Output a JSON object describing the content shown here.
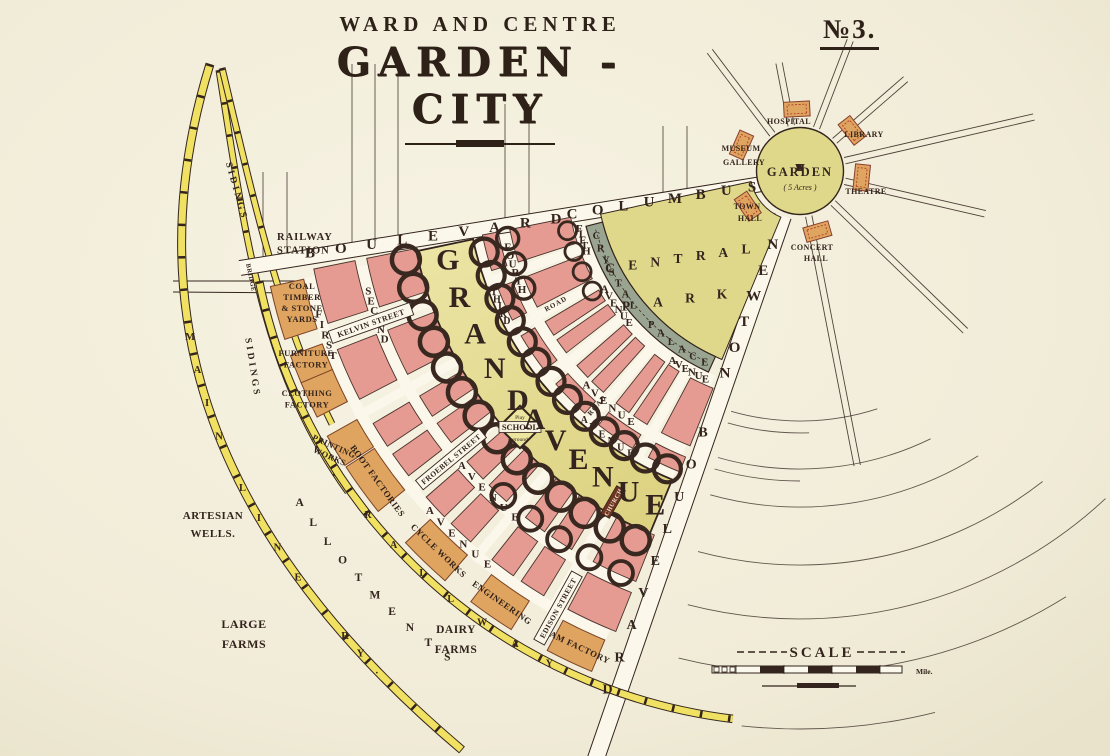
{
  "page": {
    "plate_number": "№3.",
    "title_line1": "WARD AND CENTRE",
    "title_line2": "GARDEN - CITY"
  },
  "colors": {
    "paper": "#f3efdd",
    "housing_pink": "#e59b92",
    "park_green": "#dfd88b",
    "grand_yellow": "#e6df95",
    "crystal_grey": "#9aa591",
    "factory_orange": "#dfa45f",
    "railway_yellow": "#f0e163",
    "ink": "#33241d"
  },
  "centre": {
    "garden_label": "GARDEN",
    "garden_acreage": "( 5 Acres )",
    "buildings": [
      {
        "label": "HOSPITAL",
        "lines": [
          "HOSPITAL"
        ]
      },
      {
        "label": "LIBRARY",
        "lines": [
          "LIBRARY"
        ]
      },
      {
        "label": "MUSEUM GALLERY",
        "lines": [
          "MUSEUM",
          "GALLERY"
        ]
      },
      {
        "label": "THEATRE",
        "lines": [
          "THEATRE"
        ]
      },
      {
        "label": "TOWN HALL",
        "lines": [
          "TOWN",
          "HALL"
        ]
      },
      {
        "label": "CONCERT HALL",
        "lines": [
          "CONCERT",
          "HALL"
        ]
      }
    ]
  },
  "park": {
    "central_park_lines": [
      "CENTRAL",
      "PARK"
    ],
    "crystal_palace": "CRYSTAL PALACE"
  },
  "boulevards": {
    "columbus_word1": "BOULEVARD",
    "columbus_word2": "COLUMBUS",
    "newton_word1": "NEWTON",
    "newton_word2": "BOULEVARD"
  },
  "avenues": {
    "grand_word1": "GRAND",
    "grand_word2": "AVENUE",
    "fifth": [
      "FIFTH",
      "AVENUE"
    ],
    "fourth": [
      "FOURTH",
      "AVENUE"
    ],
    "third": [
      "THIRD",
      "AVENUE"
    ],
    "second": [
      "SECOND",
      "AVENUE"
    ],
    "first": [
      "FIRST",
      "AVENUE"
    ],
    "road_label": "ROAD"
  },
  "radial_streets": {
    "kelvin": "KELVIN STREET",
    "froebel": "FROEBEL STREET",
    "edison": "EDISON STREET"
  },
  "grand_features": {
    "school": "SCHOOL",
    "school_top": "Play",
    "school_bottom": "ground",
    "church": "CHURCH"
  },
  "railway": {
    "station_lines": [
      "RAILWAY",
      "STATION"
    ],
    "bridge": "BRIDGE",
    "sidings": "SIDINGS",
    "main_line_letters": "MAIN LINE RY.",
    "circle_railway": "RAILWAY"
  },
  "industry": {
    "coal_yard_lines": [
      "COAL",
      "TIMBER",
      "& STONE",
      "YARDS"
    ],
    "furniture_lines": [
      "FURNITURE",
      "FACTORY"
    ],
    "clothing_lines": [
      "CLOTHING",
      "FACTORY"
    ],
    "printing_lines": [
      "PRINTING",
      "WORKS"
    ],
    "boot": "BOOT FACTORIES",
    "cycle": "CYCLE WORKS",
    "engineering": "ENGINEERING",
    "jam": "JAM FACTORY"
  },
  "rural": {
    "artesian_lines": [
      "ARTESIAN",
      "WELLS."
    ],
    "large_farms_lines": [
      "LARGE",
      "FARMS"
    ],
    "dairy_farms_lines": [
      "DAIRY",
      "FARMS"
    ],
    "allotments": "ALLOTMENTS"
  },
  "scale": {
    "label": "SCALE",
    "unit": "Mile."
  }
}
